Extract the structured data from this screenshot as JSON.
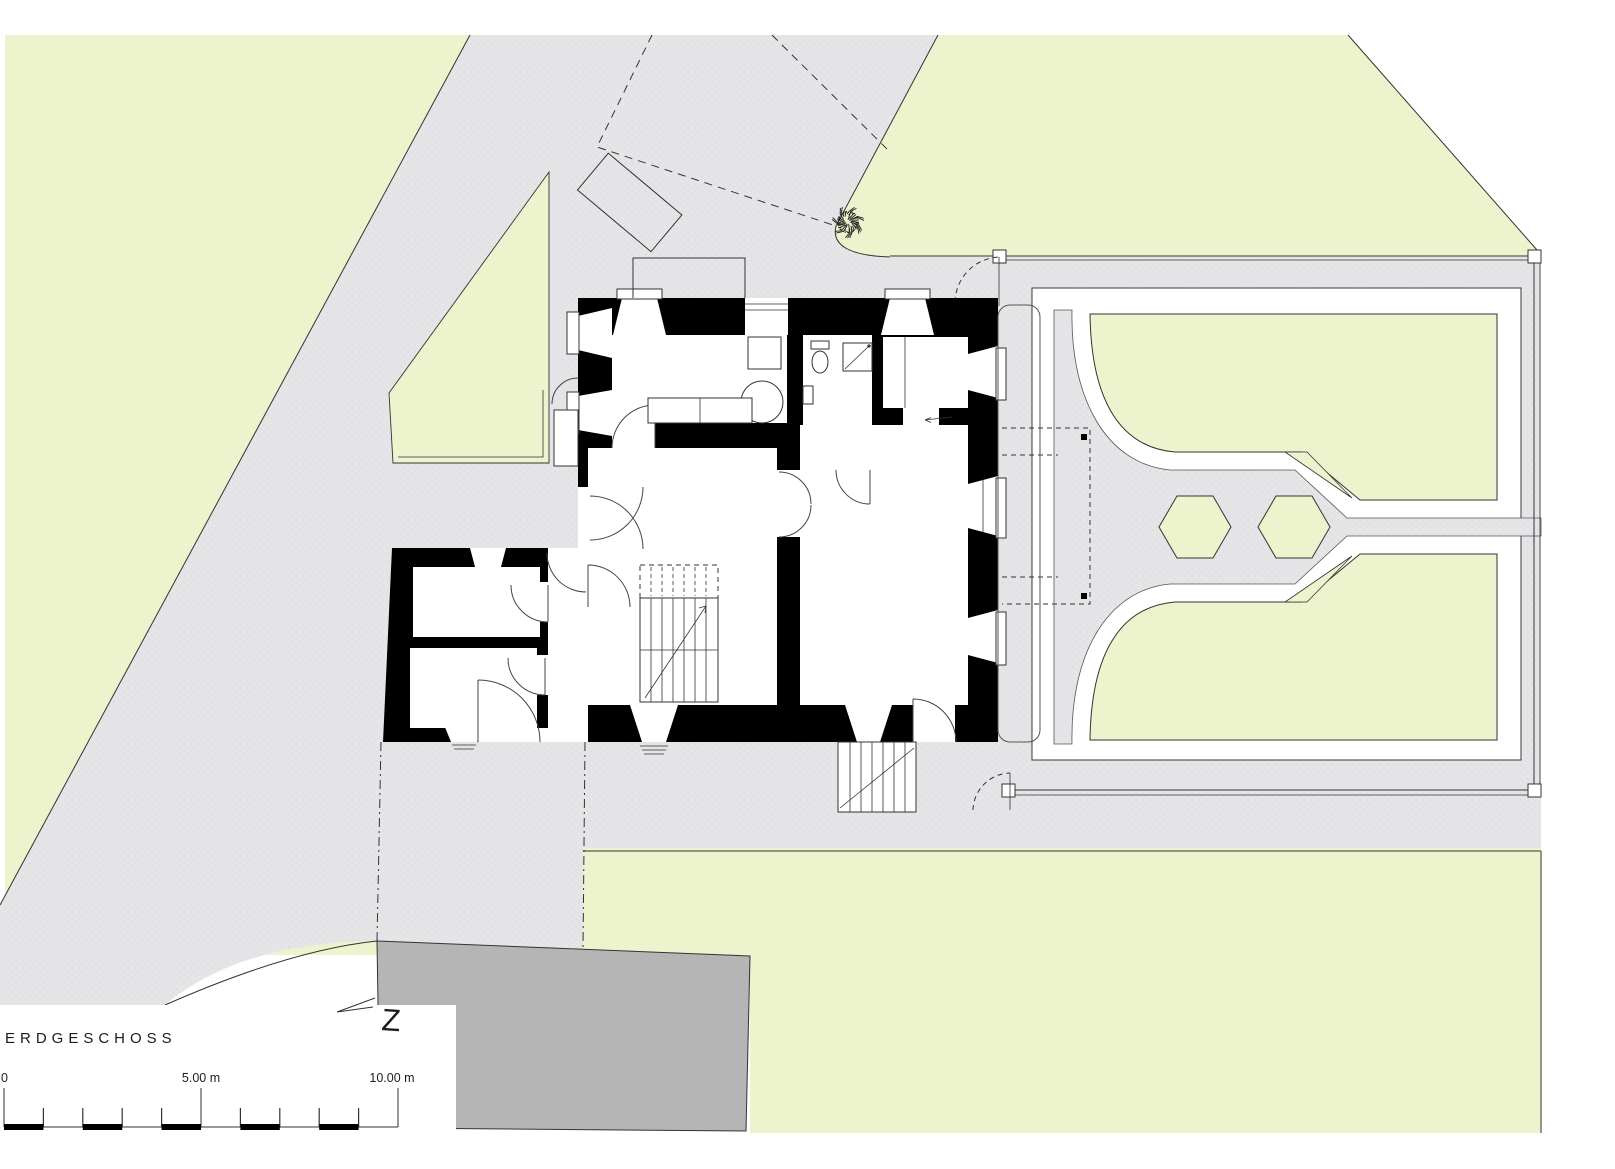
{
  "title": {
    "floor_label": "ERDGESCHOSS"
  },
  "scale_bar": {
    "tick_0": "0",
    "tick_5": "5.00 m",
    "tick_10": "10.00 m"
  },
  "north_arrow": {
    "letter": "Z"
  },
  "colors": {
    "background": "#ffffff",
    "grass": "#edf3cd",
    "paved": "#e5e5e8",
    "paved_dot": "#d9d9dd",
    "garden_path": "#ffffff",
    "neighbor_building": "#b5b5b5",
    "wall": "#000000",
    "line": "#333333"
  },
  "plan": {
    "kind": "architectural site / ground floor plan",
    "features": {
      "main_house": "black masonry walls with splayed window reveals, interior stair, bath, kitchen",
      "annex": "two-room side wing with corridor",
      "formal_garden": "two green parterres, white paths, two hexagonal beds, fenced",
      "site": "lawn, paved drive, neighbouring building, single tree, demolished outline dashed"
    }
  }
}
